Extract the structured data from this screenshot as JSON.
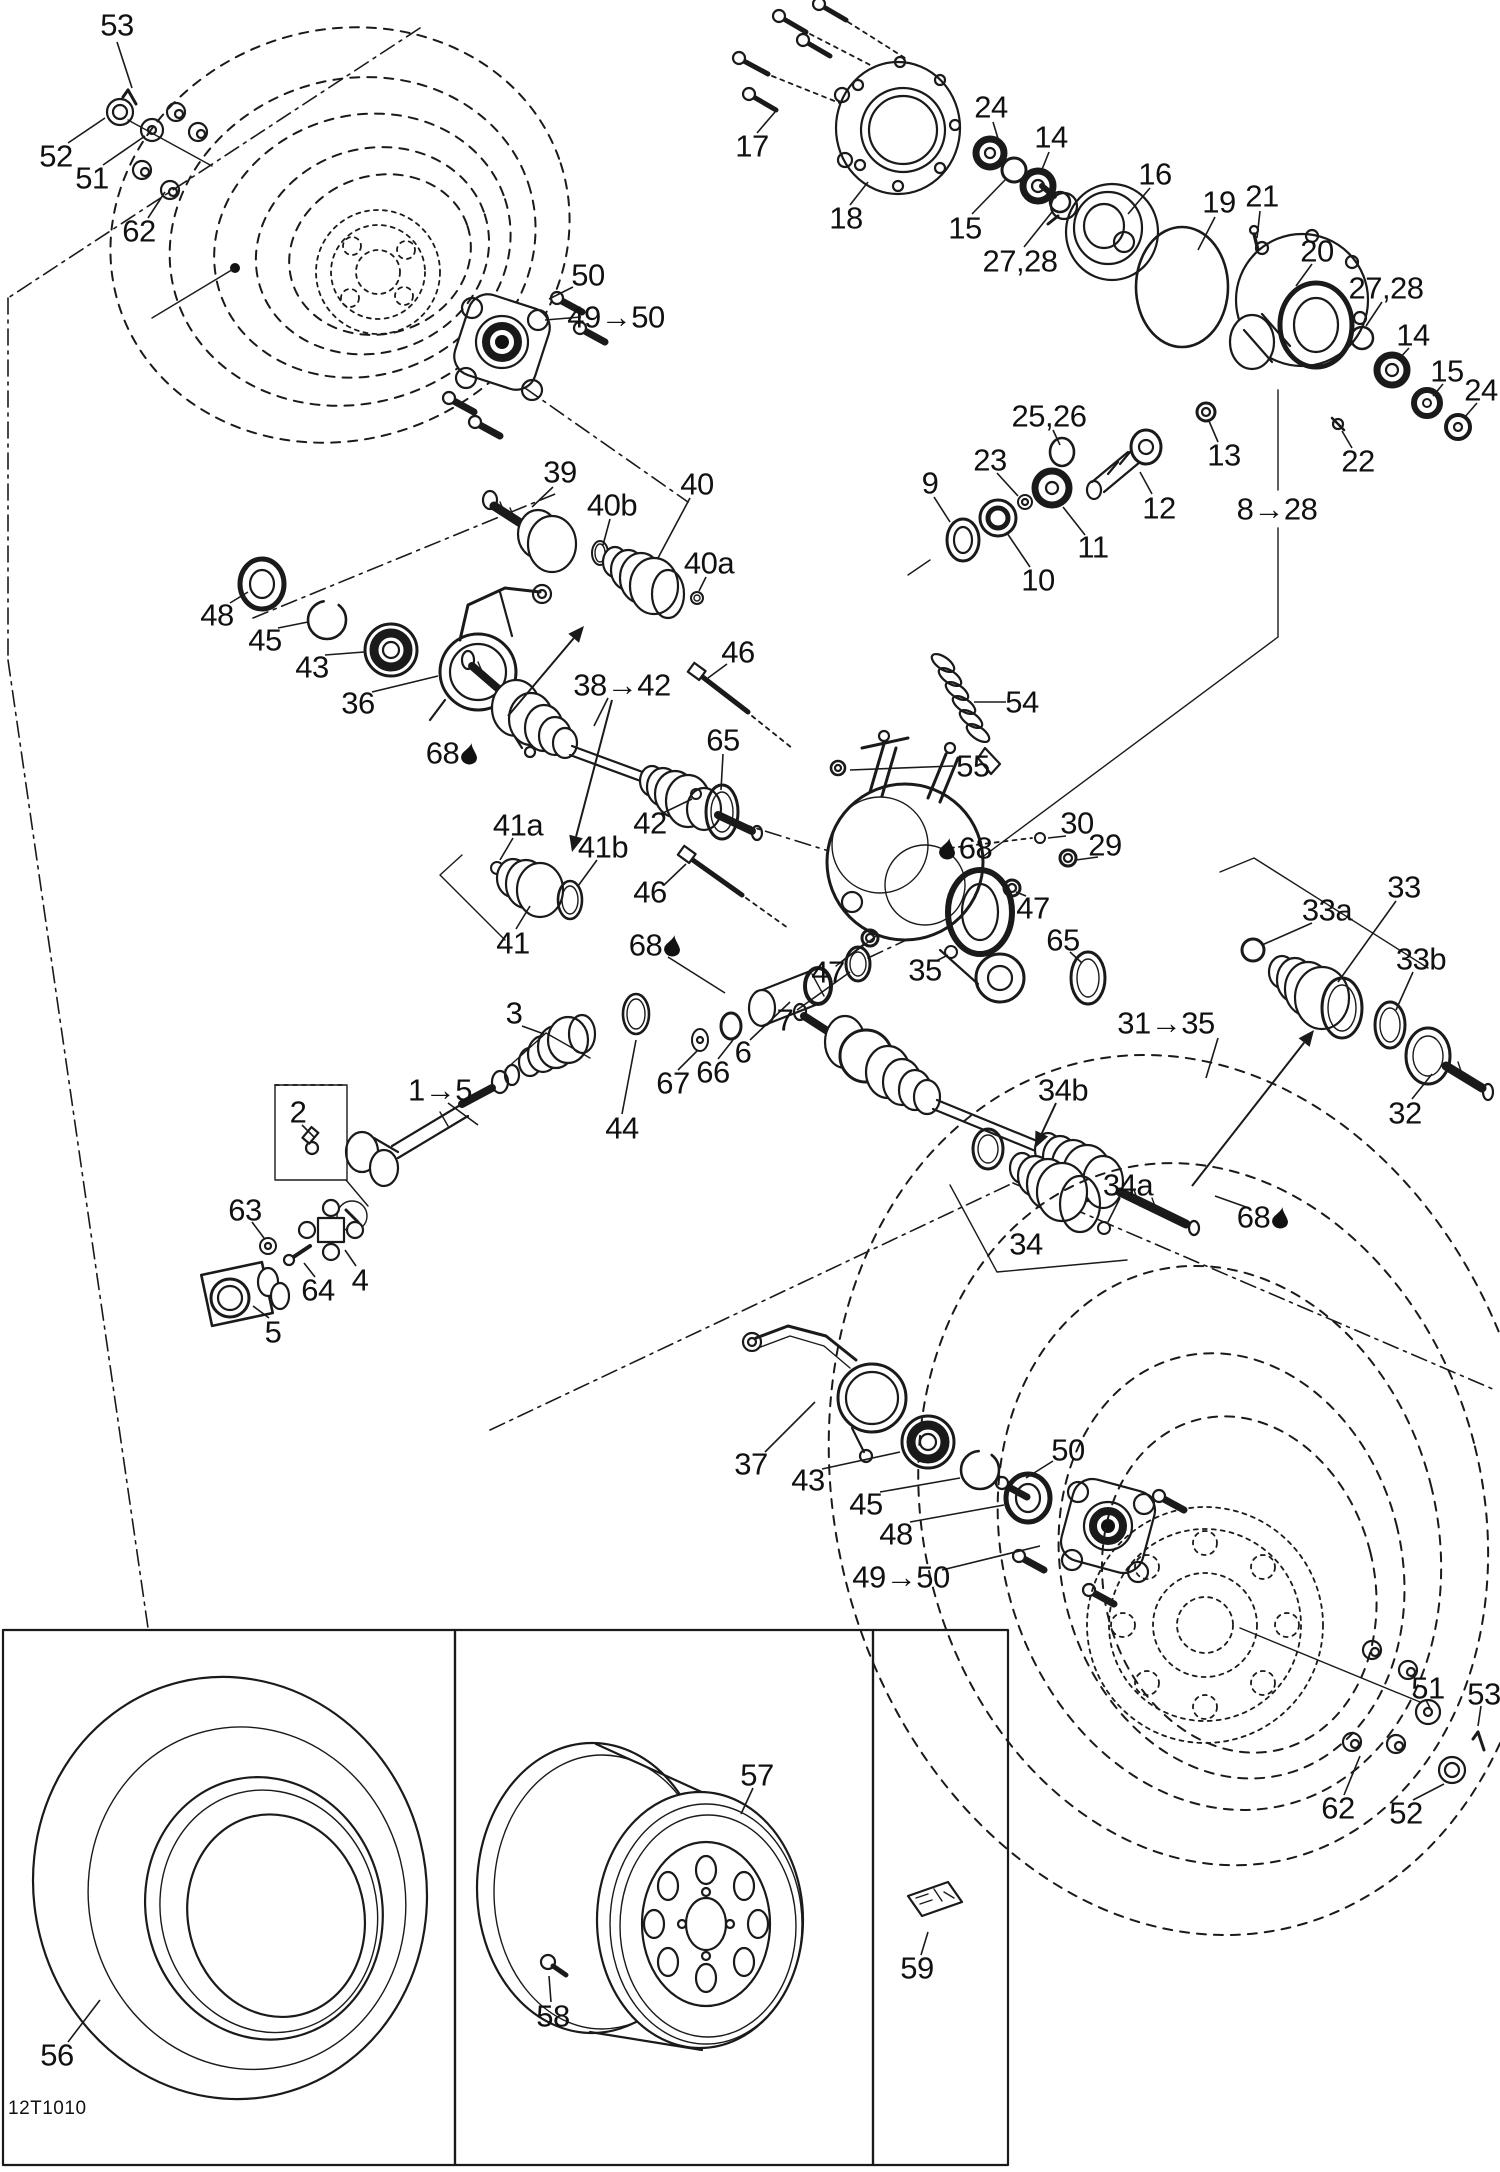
{
  "doc_code": "12T1010",
  "ink": "#1a1a1a",
  "labels": [
    [
      "53",
      117,
      25,
      [
        117,
        42,
        132,
        88
      ],
      0
    ],
    [
      "52",
      56,
      156,
      [
        68,
        143,
        105,
        118
      ],
      0
    ],
    [
      "51",
      92,
      178,
      [
        103,
        165,
        145,
        136
      ],
      0
    ],
    [
      "62",
      139,
      231,
      [
        148,
        218,
        165,
        192
      ],
      0
    ],
    [
      "50",
      588,
      275,
      [
        573,
        287,
        549,
        299
      ],
      0
    ],
    [
      "49→50",
      616,
      317,
      [
        581,
        317,
        545,
        320
      ],
      0
    ],
    [
      "17",
      752,
      146,
      [
        757,
        133,
        775,
        112
      ],
      0
    ],
    [
      "18",
      846,
      218,
      [
        850,
        205,
        868,
        182
      ],
      0
    ],
    [
      "24",
      991,
      107,
      [
        993,
        122,
        1000,
        145
      ],
      0
    ],
    [
      "14",
      1051,
      137,
      [
        1049,
        152,
        1041,
        172
      ],
      0
    ],
    [
      "15",
      965,
      228,
      [
        972,
        214,
        1005,
        180
      ],
      0
    ],
    [
      "27,28",
      1020,
      261,
      [
        1024,
        247,
        1052,
        212
      ],
      0
    ],
    [
      "16",
      1155,
      174,
      [
        1150,
        188,
        1128,
        214
      ],
      0
    ],
    [
      "19",
      1219,
      202,
      [
        1215,
        217,
        1198,
        250
      ],
      0
    ],
    [
      "21",
      1262,
      196,
      [
        1260,
        211,
        1257,
        238
      ],
      0
    ],
    [
      "20",
      1317,
      251,
      [
        1312,
        264,
        1296,
        286
      ],
      0
    ],
    [
      "27,28",
      1386,
      288,
      [
        1382,
        302,
        1366,
        326
      ],
      0
    ],
    [
      "14",
      1413,
      335,
      [
        1409,
        348,
        1398,
        360
      ],
      0
    ],
    [
      "15",
      1447,
      371,
      [
        1443,
        384,
        1433,
        396
      ],
      0
    ],
    [
      "24",
      1481,
      390,
      [
        1477,
        403,
        1464,
        418
      ],
      0
    ],
    [
      "22",
      1358,
      461,
      [
        1352,
        448,
        1342,
        431
      ],
      0
    ],
    [
      "13",
      1224,
      455,
      [
        1218,
        442,
        1209,
        421
      ],
      0
    ],
    [
      "8→28",
      1277,
      509,
      0,
      0
    ],
    [
      "12",
      1159,
      508,
      [
        1152,
        494,
        1140,
        472
      ],
      0
    ],
    [
      "25,26",
      1049,
      416,
      [
        1053,
        430,
        1060,
        445
      ],
      0
    ],
    [
      "23",
      990,
      460,
      [
        997,
        473,
        1018,
        496
      ],
      0
    ],
    [
      "11",
      1093,
      547,
      [
        1085,
        535,
        1063,
        507
      ],
      0
    ],
    [
      "10",
      1038,
      580,
      [
        1030,
        567,
        1007,
        533
      ],
      0
    ],
    [
      "9",
      930,
      483,
      [
        934,
        497,
        950,
        522
      ],
      0
    ],
    [
      "39",
      560,
      472,
      [
        553,
        487,
        532,
        507
      ],
      0
    ],
    [
      "40b",
      612,
      505,
      [
        610,
        519,
        603,
        545
      ],
      0
    ],
    [
      "40",
      697,
      484,
      [
        690,
        498,
        658,
        558
      ],
      0
    ],
    [
      "40a",
      709,
      563,
      [
        706,
        577,
        699,
        591
      ],
      0
    ],
    [
      "48",
      217,
      615,
      [
        230,
        603,
        248,
        592
      ],
      0
    ],
    [
      "45",
      265,
      640,
      [
        278,
        628,
        308,
        622
      ],
      0
    ],
    [
      "43",
      312,
      667,
      [
        325,
        655,
        364,
        652
      ],
      0
    ],
    [
      "36",
      358,
      703,
      [
        372,
        692,
        438,
        676
      ],
      0
    ],
    [
      "68",
      452,
      753,
      0,
      "a"
    ],
    [
      "38→42",
      622,
      685,
      [
        608,
        698,
        594,
        726
      ],
      0
    ],
    [
      "46",
      738,
      652,
      [
        727,
        664,
        708,
        678
      ],
      0
    ],
    [
      "65",
      723,
      740,
      [
        723,
        754,
        721,
        790
      ],
      0
    ],
    [
      "54",
      1022,
      702,
      [
        1006,
        702,
        974,
        702
      ],
      0
    ],
    [
      "55",
      973,
      766,
      [
        953,
        766,
        850,
        770
      ],
      0
    ],
    [
      "42",
      650,
      823,
      [
        663,
        813,
        692,
        799
      ],
      0
    ],
    [
      "41a",
      518,
      825,
      [
        513,
        838,
        500,
        860
      ],
      0
    ],
    [
      "41b",
      603,
      847,
      [
        597,
        860,
        578,
        886
      ],
      0
    ],
    [
      "41",
      513,
      943,
      [
        516,
        929,
        530,
        906
      ],
      0
    ],
    [
      "46",
      650,
      892,
      [
        664,
        885,
        686,
        864
      ],
      0
    ],
    [
      "68",
      655,
      945,
      [
        668,
        957,
        725,
        993
      ],
      "a"
    ],
    [
      "30",
      1077,
      823,
      [
        1066,
        836,
        1048,
        838
      ],
      0
    ],
    [
      "29",
      1105,
      845,
      [
        1098,
        857,
        1076,
        860
      ],
      0
    ],
    [
      "47",
      1033,
      908,
      [
        1026,
        896,
        1016,
        892
      ],
      0
    ],
    [
      "65",
      1063,
      940,
      [
        1070,
        952,
        1082,
        963
      ],
      0
    ],
    [
      "35",
      925,
      970,
      [
        938,
        960,
        948,
        955
      ],
      0
    ],
    [
      "47",
      828,
      972,
      [
        841,
        962,
        864,
        944
      ],
      0
    ],
    [
      "68",
      966,
      848,
      0,
      "b"
    ],
    [
      "33a",
      1327,
      910,
      [
        1312,
        923,
        1262,
        945
      ],
      0
    ],
    [
      "33",
      1404,
      887,
      [
        1396,
        901,
        1338,
        982
      ],
      0
    ],
    [
      "33b",
      1421,
      959,
      [
        1413,
        972,
        1396,
        1010
      ],
      0
    ],
    [
      "32",
      1405,
      1113,
      [
        1412,
        1099,
        1432,
        1074
      ],
      0
    ],
    [
      "31→35",
      1166,
      1023,
      [
        1218,
        1038,
        1206,
        1078
      ],
      0
    ],
    [
      "34b",
      1063,
      1090,
      0,
      0
    ],
    [
      "34a",
      1128,
      1185,
      [
        1120,
        1198,
        1108,
        1222
      ],
      0
    ],
    [
      "34",
      1026,
      1244,
      0,
      0
    ],
    [
      "68",
      1263,
      1217,
      [
        1246,
        1207,
        1215,
        1196
      ],
      "a"
    ],
    [
      "3",
      514,
      1013,
      [
        522,
        1026,
        544,
        1034
      ],
      0
    ],
    [
      "44",
      622,
      1128,
      [
        622,
        1114,
        636,
        1040
      ],
      0
    ],
    [
      "1→5",
      440,
      1090,
      [
        448,
        1103,
        478,
        1125
      ],
      0
    ],
    [
      "2",
      298,
      1112,
      [
        302,
        1125,
        314,
        1137
      ],
      0
    ],
    [
      "63",
      245,
      1210,
      [
        252,
        1222,
        264,
        1238
      ],
      0
    ],
    [
      "64",
      318,
      1290,
      [
        315,
        1277,
        304,
        1263
      ],
      0
    ],
    [
      "4",
      360,
      1280,
      [
        356,
        1266,
        345,
        1250
      ],
      0
    ],
    [
      "5",
      273,
      1332,
      [
        269,
        1318,
        253,
        1306
      ],
      0
    ],
    [
      "7",
      785,
      1020,
      [
        797,
        1010,
        850,
        972
      ],
      0
    ],
    [
      "6",
      743,
      1052,
      [
        750,
        1040,
        790,
        1002
      ],
      0
    ],
    [
      "66",
      713,
      1072,
      [
        718,
        1059,
        733,
        1040
      ],
      0
    ],
    [
      "67",
      673,
      1083,
      [
        678,
        1070,
        698,
        1050
      ],
      0
    ],
    [
      "37",
      751,
      1464,
      [
        765,
        1452,
        815,
        1402
      ],
      0
    ],
    [
      "43",
      808,
      1480,
      [
        822,
        1469,
        900,
        1452
      ],
      0
    ],
    [
      "45",
      866,
      1504,
      [
        880,
        1492,
        960,
        1478
      ],
      0
    ],
    [
      "48",
      896,
      1534,
      [
        910,
        1522,
        1004,
        1505
      ],
      0
    ],
    [
      "50",
      1068,
      1450,
      [
        1053,
        1461,
        1026,
        1478
      ],
      0
    ],
    [
      "49→50",
      901,
      1577,
      [
        942,
        1570,
        1040,
        1546
      ],
      0
    ],
    [
      "51",
      1428,
      1688,
      [
        1426,
        1700,
        1430,
        1708
      ],
      0
    ],
    [
      "53",
      1484,
      1694,
      [
        1481,
        1706,
        1478,
        1726
      ],
      0
    ],
    [
      "62",
      1338,
      1808,
      [
        1344,
        1795,
        1360,
        1756
      ],
      0
    ],
    [
      "52",
      1406,
      1813,
      [
        1413,
        1800,
        1444,
        1784
      ],
      0
    ],
    [
      "56",
      57,
      2055,
      [
        68,
        2042,
        100,
        2000
      ],
      0
    ],
    [
      "57",
      757,
      1775,
      [
        753,
        1788,
        741,
        1814
      ],
      0
    ],
    [
      "58",
      553,
      2016,
      [
        551,
        2002,
        549,
        1976
      ],
      0
    ],
    [
      "59",
      917,
      1968,
      [
        921,
        1955,
        928,
        1932
      ],
      0
    ]
  ],
  "arrows": [
    [
      612,
      700,
      572,
      852
    ],
    [
      508,
      716,
      584,
      626
    ],
    [
      1192,
      1186,
      1314,
      1030
    ],
    [
      1056,
      1103,
      1035,
      1148
    ]
  ]
}
